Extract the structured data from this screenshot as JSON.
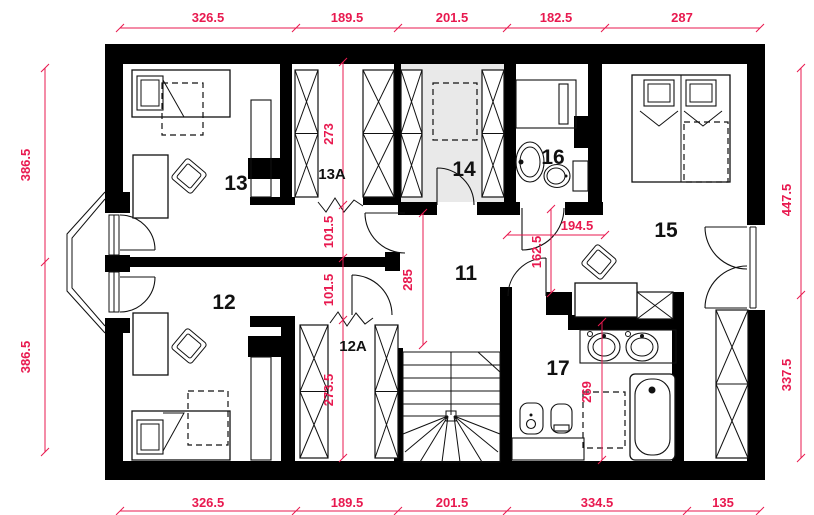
{
  "rooms": {
    "r11": "11",
    "r12": "12",
    "r12a": "12A",
    "r13": "13",
    "r13a": "13A",
    "r14": "14",
    "r15": "15",
    "r16": "16",
    "r17": "17"
  },
  "dims": {
    "top": [
      "326.5",
      "189.5",
      "201.5",
      "182.5",
      "287"
    ],
    "bottom": [
      "326.5",
      "189.5",
      "201.5",
      "334.5",
      "135"
    ],
    "left": [
      "386.5",
      "386.5"
    ],
    "right": [
      "447.5",
      "337.5"
    ],
    "interior": {
      "closet13a": "273",
      "passage_upper": "101.5",
      "passage_lower": "101.5",
      "closet12a": "273.5",
      "hall_length": "285",
      "hall_side": "162.5",
      "hall_top": "194.5",
      "bath17": "269"
    }
  },
  "colors": {
    "dimension": "#e8194f",
    "wall": "#000000",
    "closet_floor": "#e9e9e9",
    "background": "#ffffff"
  }
}
